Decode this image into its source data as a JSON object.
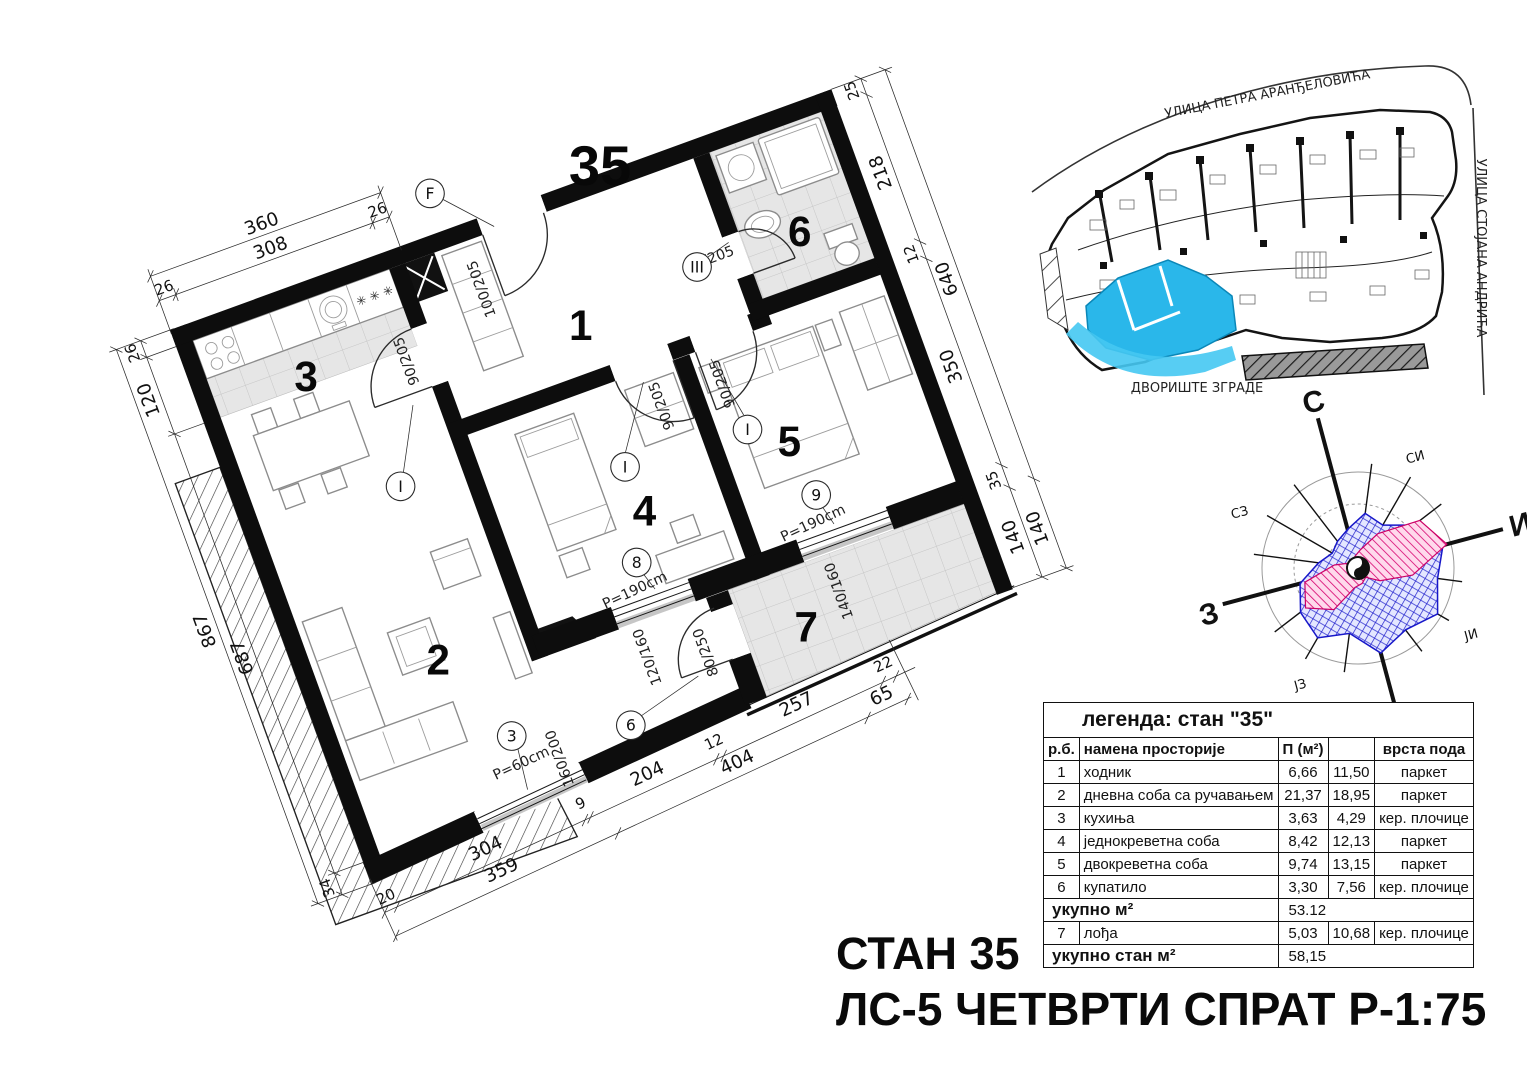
{
  "plan": {
    "apartment_number": "35",
    "rooms": {
      "n1": "1",
      "n2": "2",
      "n3": "3",
      "n4": "4",
      "n5": "5",
      "n6": "6",
      "n7": "7"
    },
    "dims": {
      "top_outer": "360",
      "top_inner": [
        "26",
        "308",
        "26"
      ],
      "left_outer": "867",
      "left_inner": [
        "26",
        "120",
        "687",
        "34"
      ],
      "right_inner": [
        "25",
        "218",
        "12",
        "350",
        "35",
        "140"
      ],
      "right_outer": [
        "640",
        "140"
      ],
      "bottom_inner": [
        "20",
        "304",
        "9",
        "204",
        "12",
        "257",
        "22"
      ],
      "bottom_outer": [
        "359",
        "404",
        "65"
      ]
    },
    "openings": {
      "entrance_door": "100/205",
      "interior_door": "90/205",
      "bath_door": "70/205",
      "balcony_door": "80/250",
      "living_window": "160/200",
      "loggia_window_8": "120/160",
      "loggia_window_9": "140/160",
      "parapet_60": "P=60cm",
      "parapet_190": "P=190cm"
    },
    "markers": {
      "entrance": "F",
      "interior": "I",
      "bath": "III",
      "w3": "3",
      "w6": "6",
      "w8": "8",
      "w9": "9"
    },
    "kitchen_stars": "✳ ✳ ✳"
  },
  "site_plan": {
    "street_top": "УЛИЦА ПЕТРА АРАНЂЕЛОВИЋА",
    "street_right": "УЛИЦА СТОЈАНА АНДРИЋА",
    "courtyard": "ДВОРИШТЕ ЗГРАДЕ",
    "highlight_color": "#2ab7ea"
  },
  "compass": {
    "n": "С",
    "e": "И",
    "s": "Ј",
    "w": "З",
    "ne": "СИ",
    "se": "ЈИ",
    "sw": "ЈЗ",
    "nw": "СЗ"
  },
  "legend": {
    "title": "легенда: стан \"35\"",
    "col_rb": "р.б.",
    "col_name": "намена просторије",
    "col_area": "П (м²)",
    "col_floor": "врста пода",
    "rows": [
      {
        "n": "1",
        "name": "ходник",
        "a": "6,66",
        "b": "11,50",
        "floor": "паркет"
      },
      {
        "n": "2",
        "name": "дневна соба са ручавањем",
        "a": "21,37",
        "b": "18,95",
        "floor": "паркет"
      },
      {
        "n": "3",
        "name": "кухиња",
        "a": "3,63",
        "b": "4,29",
        "floor": "кер. плочице"
      },
      {
        "n": "4",
        "name": "једнокреветна соба",
        "a": "8,42",
        "b": "12,13",
        "floor": "паркет"
      },
      {
        "n": "5",
        "name": "двокреветна соба",
        "a": "9,74",
        "b": "13,15",
        "floor": "паркет"
      },
      {
        "n": "6",
        "name": "купатило",
        "a": "3,30",
        "b": "7,56",
        "floor": "кер. плочице"
      },
      {
        "n": "7",
        "name": "лођа",
        "a": "5,03",
        "b": "10,68",
        "floor": "кер. плочице"
      }
    ],
    "total_label": "укупно м²",
    "total_value": "53.12",
    "total_flat_label": "укупно стан м²",
    "total_flat_value": "58,15"
  },
  "titles": {
    "line1": "СТАН 35",
    "line2": "ЛС-5 ЧЕТВРТИ СПРАТ Р-1:75"
  }
}
